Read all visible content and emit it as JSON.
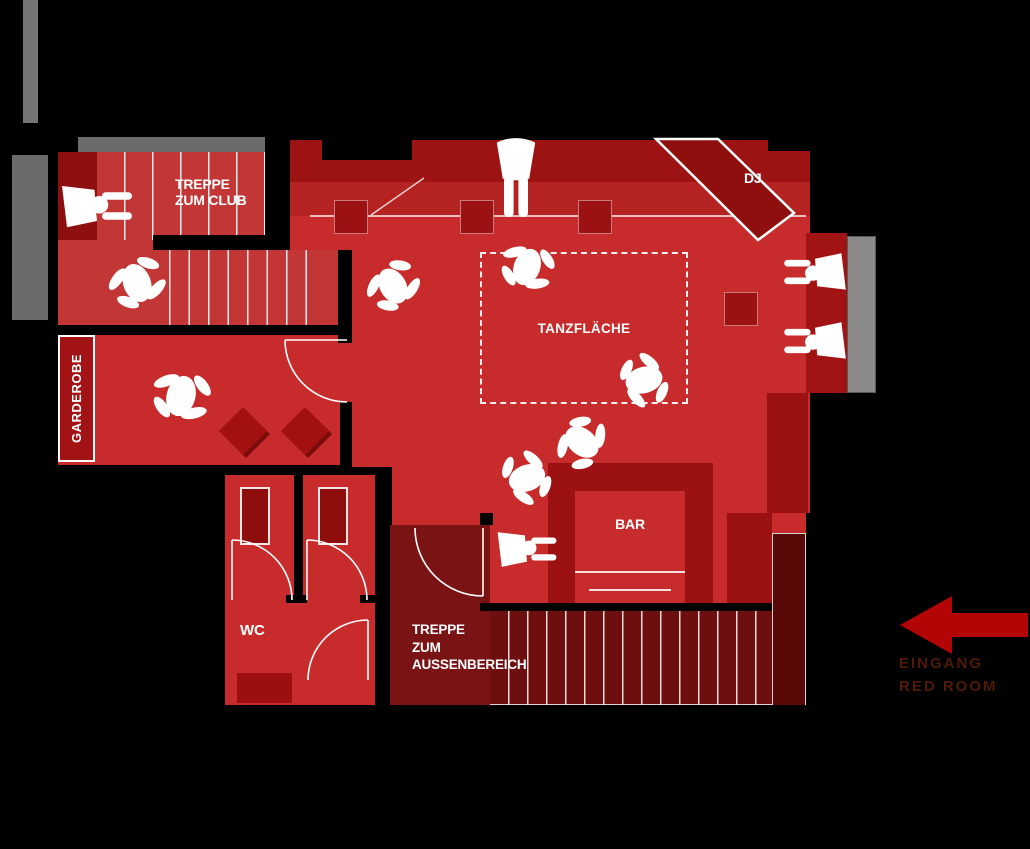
{
  "plan": {
    "rooms": {
      "treppe_club": {
        "line1": "TREPPE",
        "line2": "ZUM CLUB"
      },
      "garderobe": {
        "label": "GARDEROBE"
      },
      "dance_floor": {
        "label": "TANZFLÄCHE"
      },
      "dj_booth": {
        "label": "DJ"
      },
      "bar": {
        "label": "BAR"
      },
      "wc": {
        "label": "WC"
      },
      "treppe_aussen": {
        "line1": "TREPPE",
        "line2": "ZUM",
        "line3": "AUSSENBEREICH"
      }
    },
    "entrance": {
      "line1": "EINGANG",
      "line2": "RED ROOM"
    },
    "icons": {
      "arrow": "left-arrow-icon",
      "dancer": "dancing-person-silhouette",
      "stander": "standing-person-silhouette",
      "walker": "walking-person-silhouette"
    },
    "colors": {
      "background": "#000000",
      "room_red": "#c72b2b",
      "stair_red": "#c23636",
      "dark_red": "#9c1111",
      "band_dark": "#9d1212",
      "band_mid": "#b52222",
      "outside_stair_room": "#7a1414",
      "bottom_stairs": "#6d0f0f",
      "deep_block": "#5a0909",
      "gray_wall": "#757575",
      "arrow_red": "#b30505",
      "entrance_text": "#511a06",
      "line_white": "#ffffff"
    }
  }
}
